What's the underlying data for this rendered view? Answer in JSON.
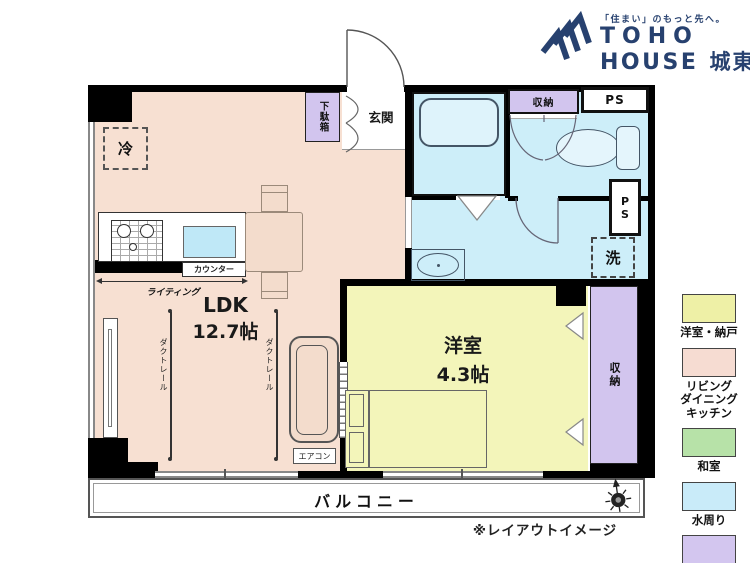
{
  "brand": {
    "tagline": "「住まい」のもっと先へ。",
    "name_line1": "TOHO",
    "name_line2": "HOUSE",
    "branch": "城東",
    "color": "#27416f"
  },
  "plan": {
    "ldk_label": "LDK",
    "ldk_size": "12.7帖",
    "western_label": "洋室",
    "western_size": "4.3帖",
    "entrance": "玄関",
    "shoe_cabinet": "下駄箱",
    "fridge": "冷",
    "closet_wc": "収納",
    "closet_bedroom": "収納",
    "ps_top": "PS",
    "ps_side": "PS",
    "washer": "洗",
    "counter": "カウンター",
    "lighting": "ライティング",
    "duct_rail": "ダクトレール",
    "aircon": "エアコン",
    "balcony": "バルコニー",
    "note": "※レイアウトイメージ"
  },
  "legend": {
    "items": [
      {
        "label": "洋室・納戸",
        "color": "#eef0a6"
      },
      {
        "label": "リビング\nダイニング\nキッチン",
        "color": "#f6dcd2"
      },
      {
        "label": "和室",
        "color": "#b7e2a8"
      },
      {
        "label": "水周り",
        "color": "#c9ebf9"
      },
      {
        "label": "収納",
        "color": "#d3c6ef"
      }
    ]
  },
  "colors": {
    "ldk": "#f7e0d2",
    "western": "#f3f5ba",
    "water": "#cdeef9",
    "storage": "#d2c5ee",
    "wall": "#000000",
    "brand_navy": "#27416f"
  }
}
